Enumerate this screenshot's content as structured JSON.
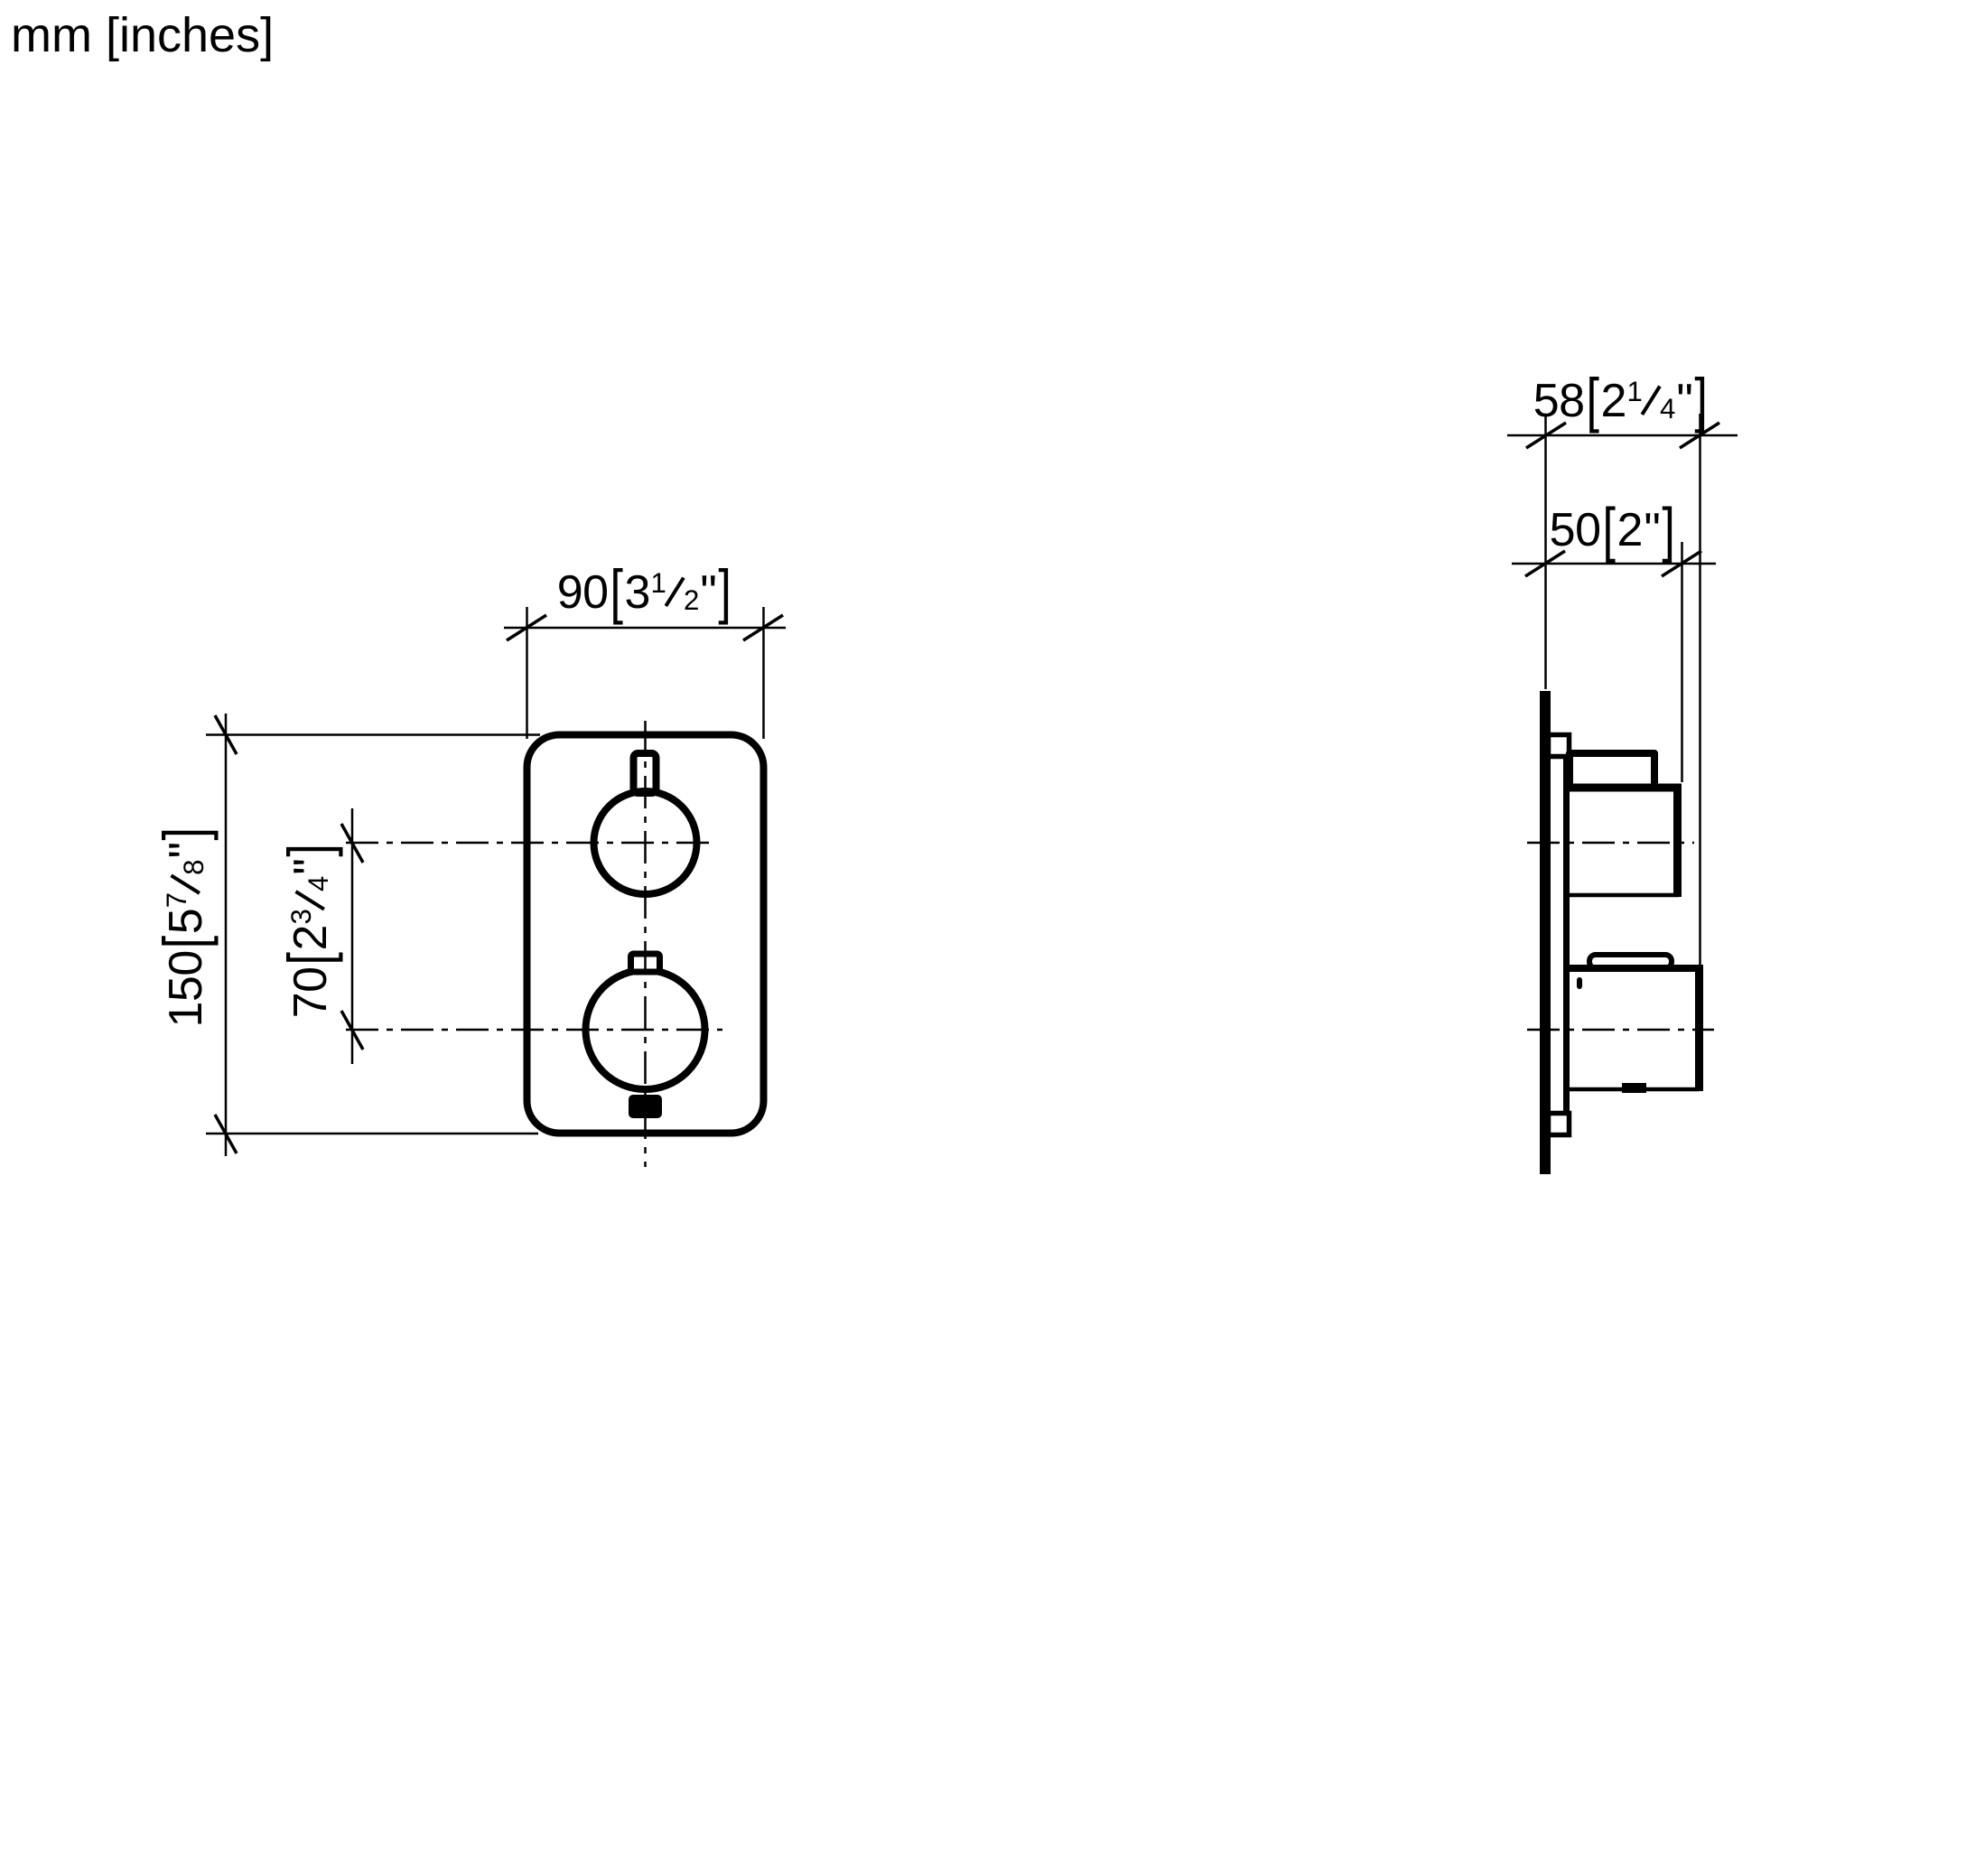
{
  "units_label": "mm [inches]",
  "symbols": {
    "open_bracket": "[",
    "close_bracket": "]",
    "inch_mark": "\""
  },
  "dimensions": {
    "front_width": {
      "mm": "90",
      "inch_whole": "3",
      "frac_num": "1",
      "frac_den": "2"
    },
    "front_height": {
      "mm": "150",
      "inch_whole": "5",
      "frac_num": "7",
      "frac_den": "8"
    },
    "handle_spacing": {
      "mm": "70",
      "inch_whole": "2",
      "frac_num": "3",
      "frac_den": "4"
    },
    "depth_overall": {
      "mm": "58",
      "inch_whole": "2",
      "frac_num": "1",
      "frac_den": "4"
    },
    "depth_to_handle": {
      "mm": "50",
      "inch_whole": "2"
    }
  },
  "colors": {
    "line": "#000000",
    "background": "#ffffff"
  }
}
